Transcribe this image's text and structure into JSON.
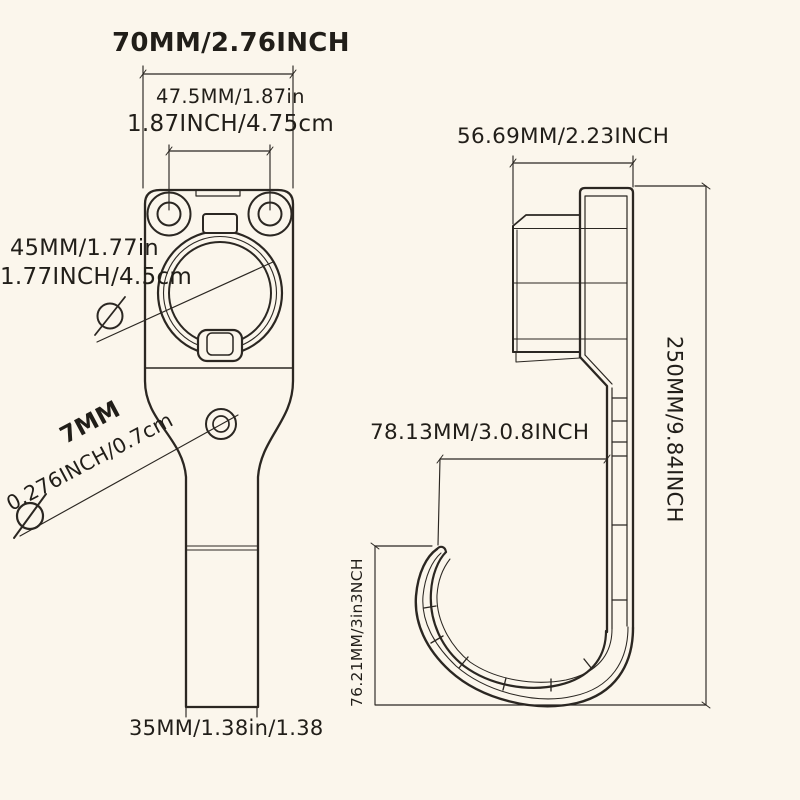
{
  "meta": {
    "description": "Technical dimension drawing of an EV charging plug holder / hook bracket, front view and side view",
    "colors": {
      "background": "#fbf6ec",
      "ink": "#2b2722",
      "text": "#211e19"
    }
  },
  "front_view": {
    "dims": {
      "overall_width_top": "70MM/2.76INCH",
      "hole_spacing_line1": "47.5MM/1.87in",
      "hole_spacing_line2": "1.87INCH/4.75cm",
      "socket_dia_line1": "45MM/1.77in",
      "socket_dia_line2": "1.77INCH/4.5cm",
      "small_hole_line1": "7MM",
      "small_hole_line2": "0.276INCH/0.7cm",
      "bottom_width": "35MM/1.38in/1.38"
    }
  },
  "side_view": {
    "dims": {
      "top_width": "56.69MM/2.23INCH",
      "hook_opening": "78.13MM/3.0.8INCH",
      "overall_height": "250MM/9.84INCH",
      "hook_height": "76.21MM/3in3NCH"
    }
  },
  "symbols": {
    "diameter": "Ø"
  }
}
